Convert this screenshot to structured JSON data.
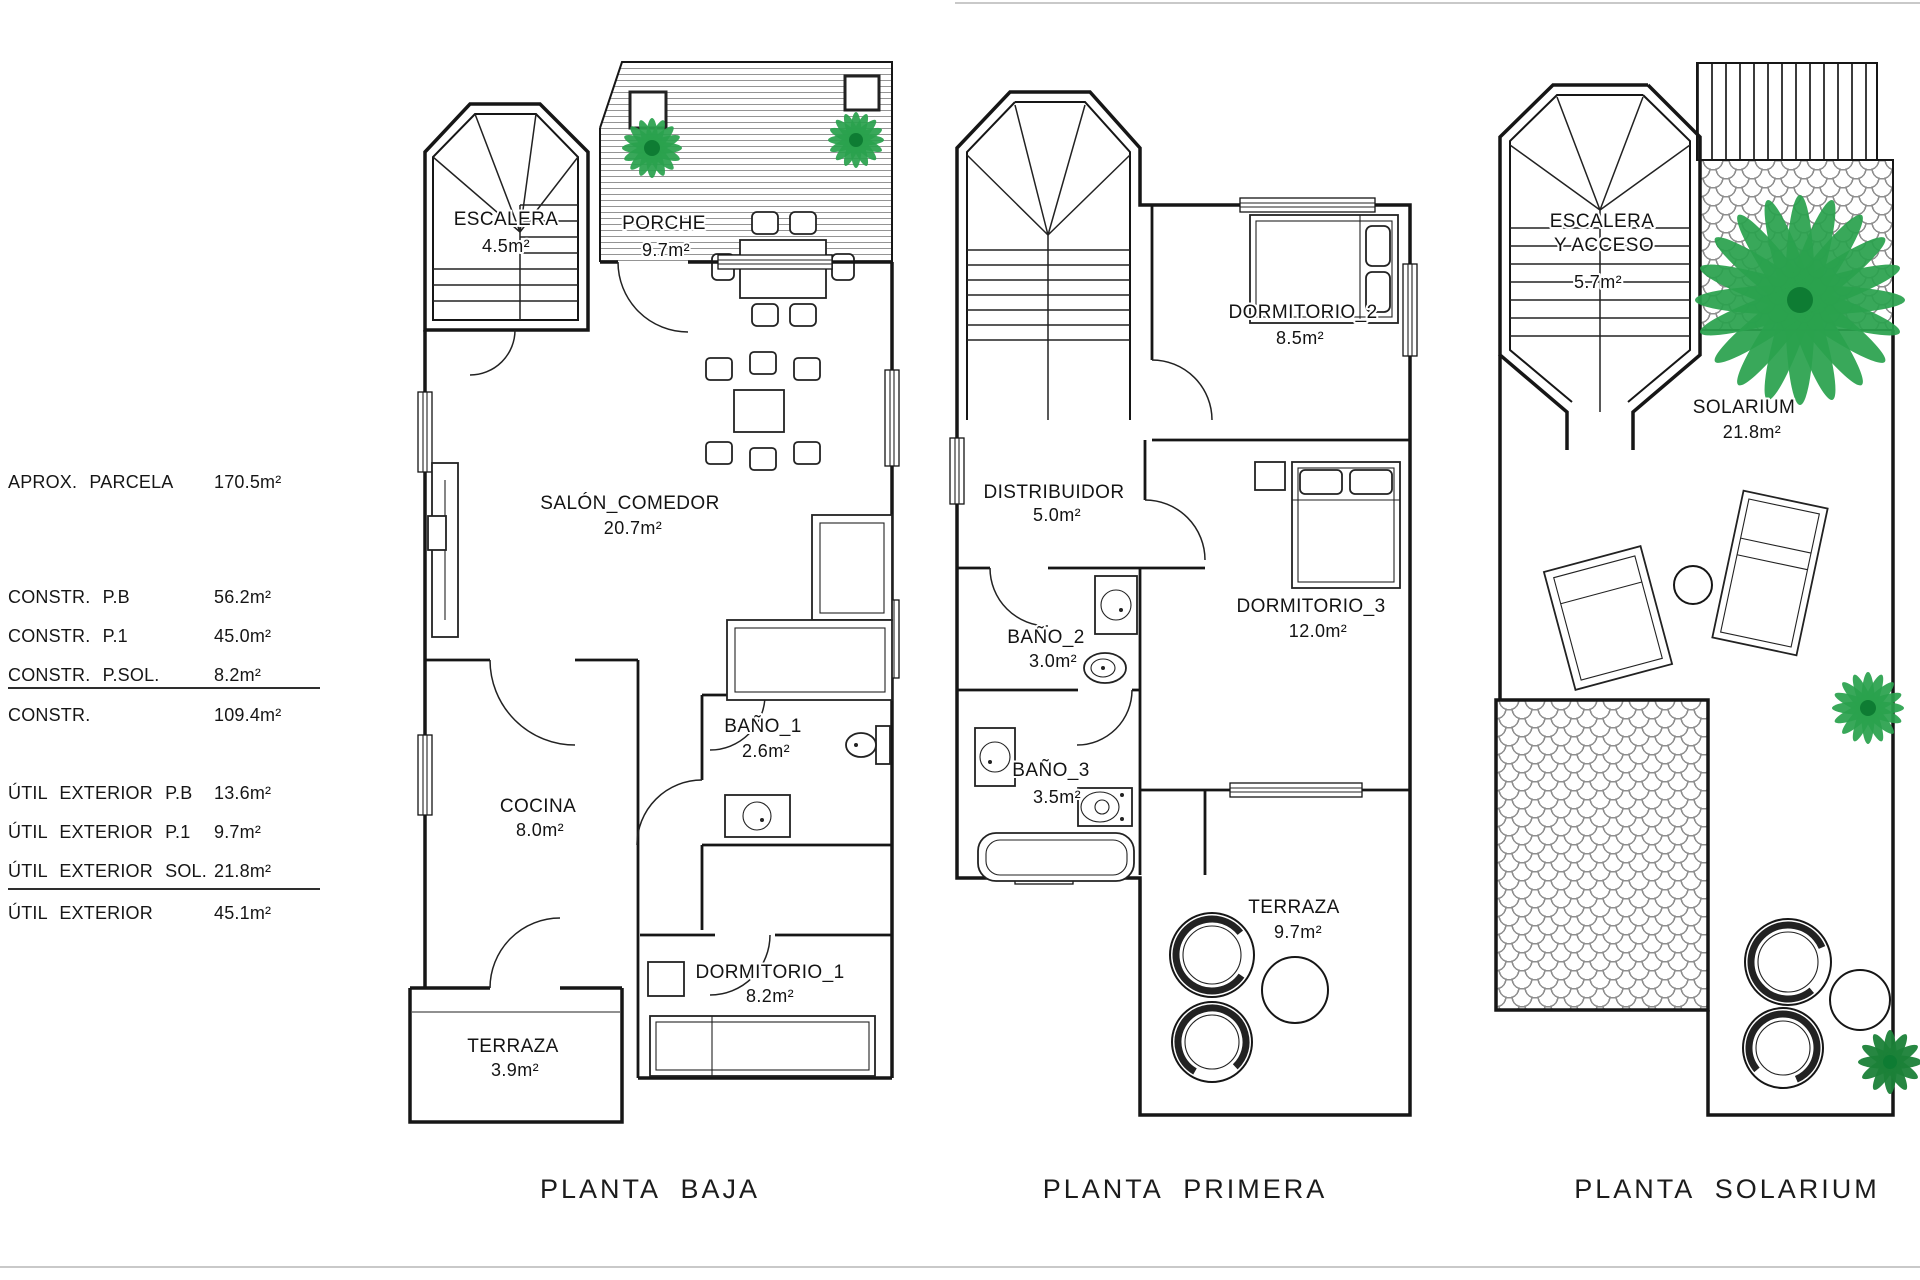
{
  "summary": {
    "rows": [
      {
        "label": "APROX. PARCELA",
        "value": "170.5m²"
      },
      {
        "label": "CONSTR. P.B",
        "value": "56.2m²"
      },
      {
        "label": "CONSTR. P.1",
        "value": "45.0m²"
      },
      {
        "label": "CONSTR. P.SOL.",
        "value": "8.2m²"
      },
      {
        "label": "CONSTR.",
        "value": "109.4m²"
      },
      {
        "label": "ÚTIL EXTERIOR P.B",
        "value": "13.6m²"
      },
      {
        "label": "ÚTIL EXTERIOR P.1",
        "value": "9.7m²"
      },
      {
        "label": "ÚTIL EXTERIOR SOL.",
        "value": "21.8m²"
      },
      {
        "label": "ÚTIL EXTERIOR",
        "value": "45.1m²"
      }
    ]
  },
  "plans": {
    "baja": {
      "title": "PLANTA  BAJA",
      "escalera_name": "ESCALERA",
      "escalera_area": "4.5m²",
      "porche_name": "PORCHE",
      "porche_area": "9.7m²",
      "salon_name": "SALÓN_COMEDOR",
      "salon_area": "20.7m²",
      "bano1_name": "BAÑO_1",
      "bano1_area": "2.6m²",
      "cocina_name": "COCINA",
      "cocina_area": "8.0m²",
      "dorm1_name": "DORMITORIO_1",
      "dorm1_area": "8.2m²",
      "terraza_name": "TERRAZA",
      "terraza_area": "3.9m²"
    },
    "primera": {
      "title": "PLANTA  PRIMERA",
      "dorm2_name": "DORMITORIO_2",
      "dorm2_area": "8.5m²",
      "distribuidor_name": "DISTRIBUIDOR",
      "distribuidor_area": "5.0m²",
      "bano2_name": "BAÑO_2",
      "bano2_area": "3.0m²",
      "dorm3_name": "DORMITORIO_3",
      "dorm3_area": "12.0m²",
      "bano3_name": "BAÑO_3",
      "bano3_area": "3.5m²",
      "terraza_name": "TERRAZA",
      "terraza_area": "9.7m²"
    },
    "solarium": {
      "title": "PLANTA  SOLARIUM",
      "escalera_line1": "ESCALERA",
      "escalera_line2": "Y  ACCESO",
      "escalera_area": "5.7m²",
      "solarium_name": "SOLARIUM",
      "solarium_area": "21.8m²"
    }
  },
  "colors": {
    "wall": "#161616",
    "plant_green": "#2aa14d",
    "plant_dark_green": "#1b8138",
    "hatch_gray": "#8f8f8f"
  }
}
